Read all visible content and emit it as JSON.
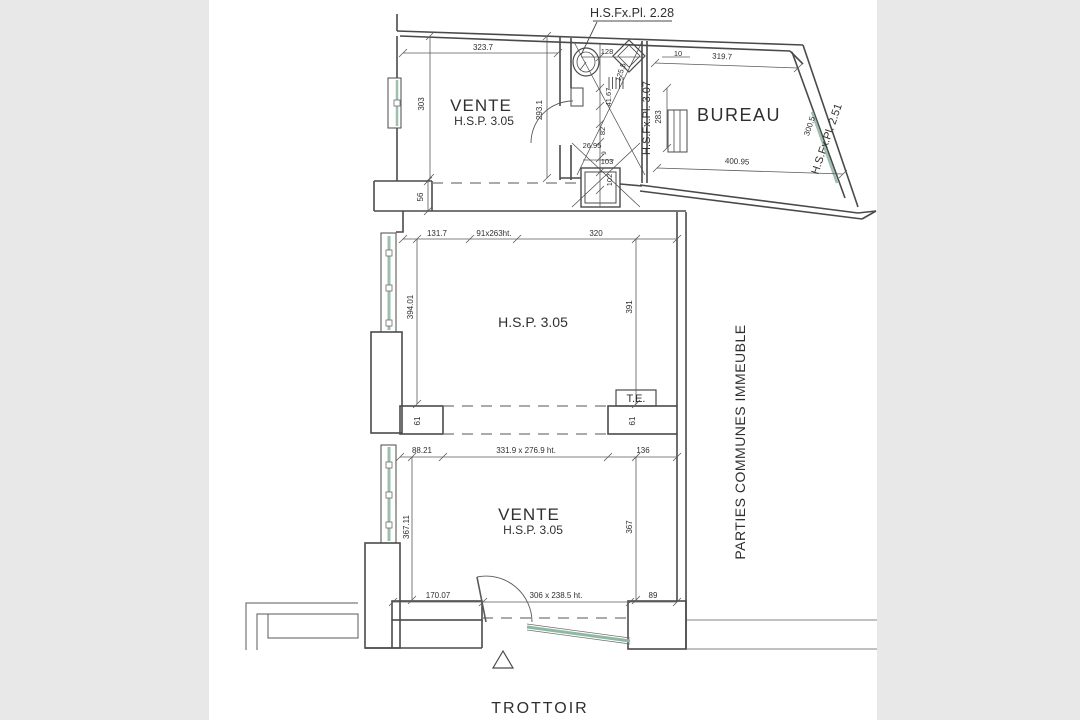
{
  "colors": {
    "gutter": "#e8e8e8",
    "paper": "#ffffff",
    "line": "#4a4a4a",
    "dim_line": "#5a5a5a",
    "text": "#2f2f2f",
    "glass_green": "#9dbfad"
  },
  "labels": {
    "ceiling_note_top": "H.S.Fx.Pl. 2.28",
    "vente_top_name": "VENTE",
    "vente_top_ceiling": "H.S.P. 3.05",
    "bureau_name": "BUREAU",
    "bureau_ceiling_left": "H.S.Fx.Pl. 3.07",
    "bureau_ceiling_right": "H.S.Fx.Pl. 2.51",
    "main_ceiling": "H.S.P. 3.05",
    "te_box": "T.E.",
    "vente_bottom_name": "VENTE",
    "vente_bottom_ceiling": "H.S.P. 3.05",
    "parties_communes": "PARTIES COMMUNES IMMEUBLE",
    "trottoir": "TROTTOIR"
  },
  "dims": {
    "vente_top_width": "323.7",
    "vente_top_left": "303",
    "vente_top_right": "293.1",
    "bath_128": "128",
    "bath_10": "10",
    "bath_125_5": "125.5",
    "bath_41_67": "41.67",
    "bath_82": "82",
    "bath_26_95": "26.95",
    "bath_9": "9",
    "bath_103": "103",
    "shaft_102": "102",
    "bureau_top": "319.7",
    "bureau_bottom": "400.95",
    "bureau_right": "300.5",
    "bureau_left": "283",
    "wall_56": "56",
    "main_seg1": "131.7",
    "main_door": "91x263ht.",
    "main_seg3": "320",
    "main_left": "394.01",
    "main_right": "391",
    "passage_left": "61",
    "passage_right": "61",
    "lower_seg1": "88.21",
    "lower_opening": "331.9 x 276.9 ht.",
    "lower_seg3": "136",
    "lower_left": "367.11",
    "lower_right": "367",
    "bottom_seg1": "170.07",
    "bottom_door": "306 x 238.5 ht.",
    "bottom_seg3": "89"
  }
}
